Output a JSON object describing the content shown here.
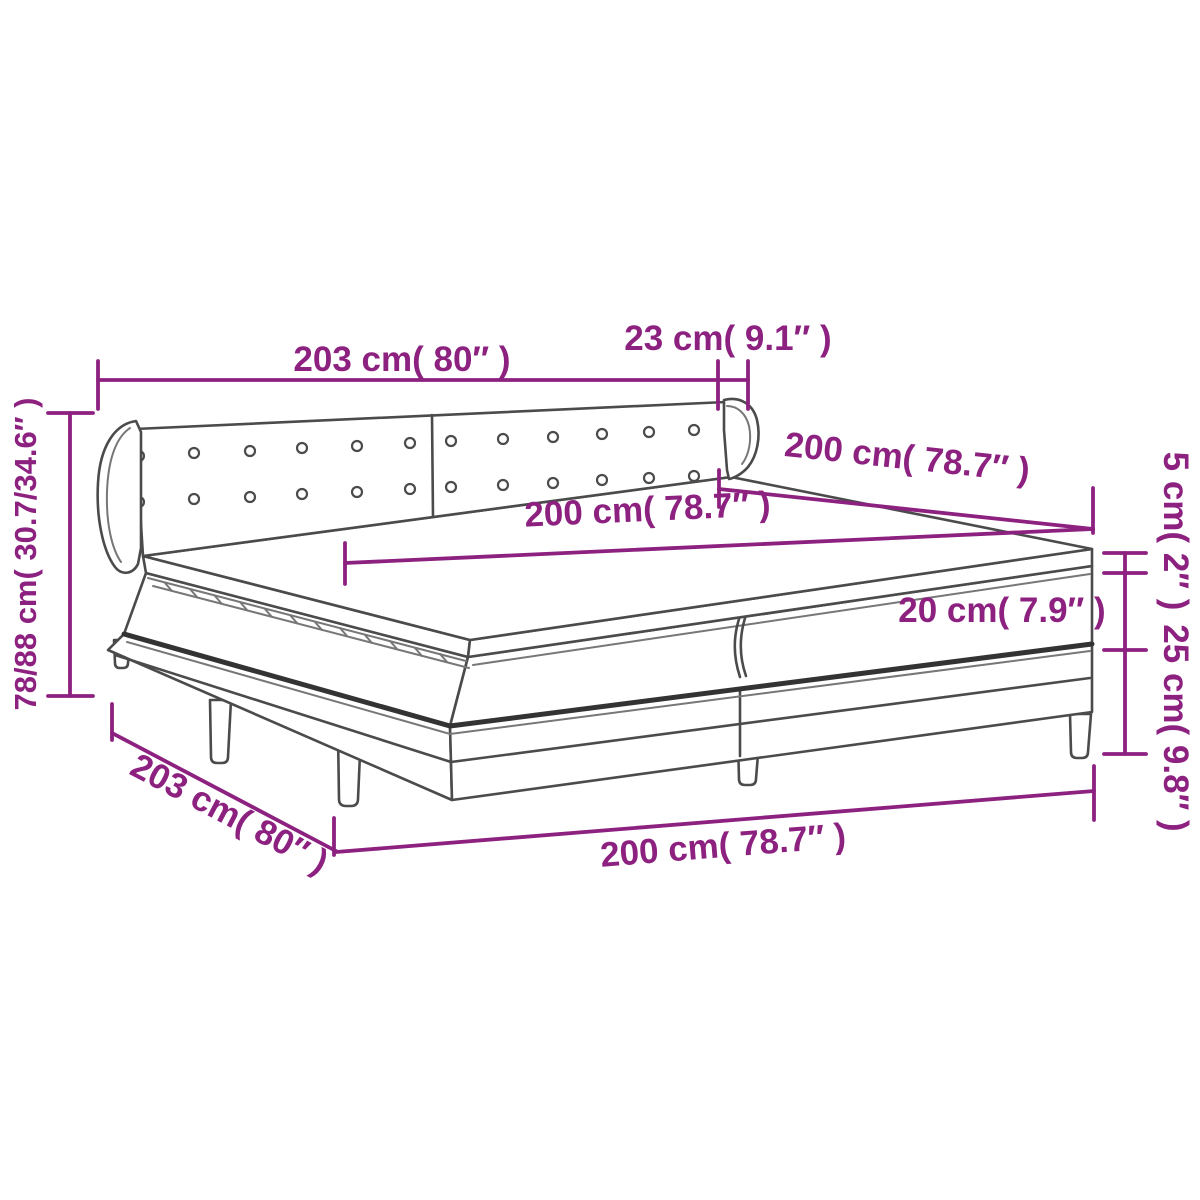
{
  "diagram": {
    "subject": "box-spring-bed-dimension-diagram",
    "colors": {
      "dimension_accent": "#8D2180",
      "drawing_outline": "#4B4B4B",
      "background": "#FFFFFF"
    },
    "labels": {
      "top_width": "203 cm( 80″ )",
      "headboard_wing_depth": "23 cm( 9.1″ )",
      "left_height": "78/88 cm( 30.7/34.6″ )",
      "upper_length": "200 cm( 78.7″ )",
      "mattress_width": "200 cm( 78.7″ )",
      "topper_height": "5 cm( 2″ )",
      "mattress_height": "20 cm( 7.9″ )",
      "base_height": "25 cm( 9.8″ )",
      "side_depth": "203 cm( 80″ )",
      "bottom_length": "200 cm( 78.7″ )"
    }
  }
}
